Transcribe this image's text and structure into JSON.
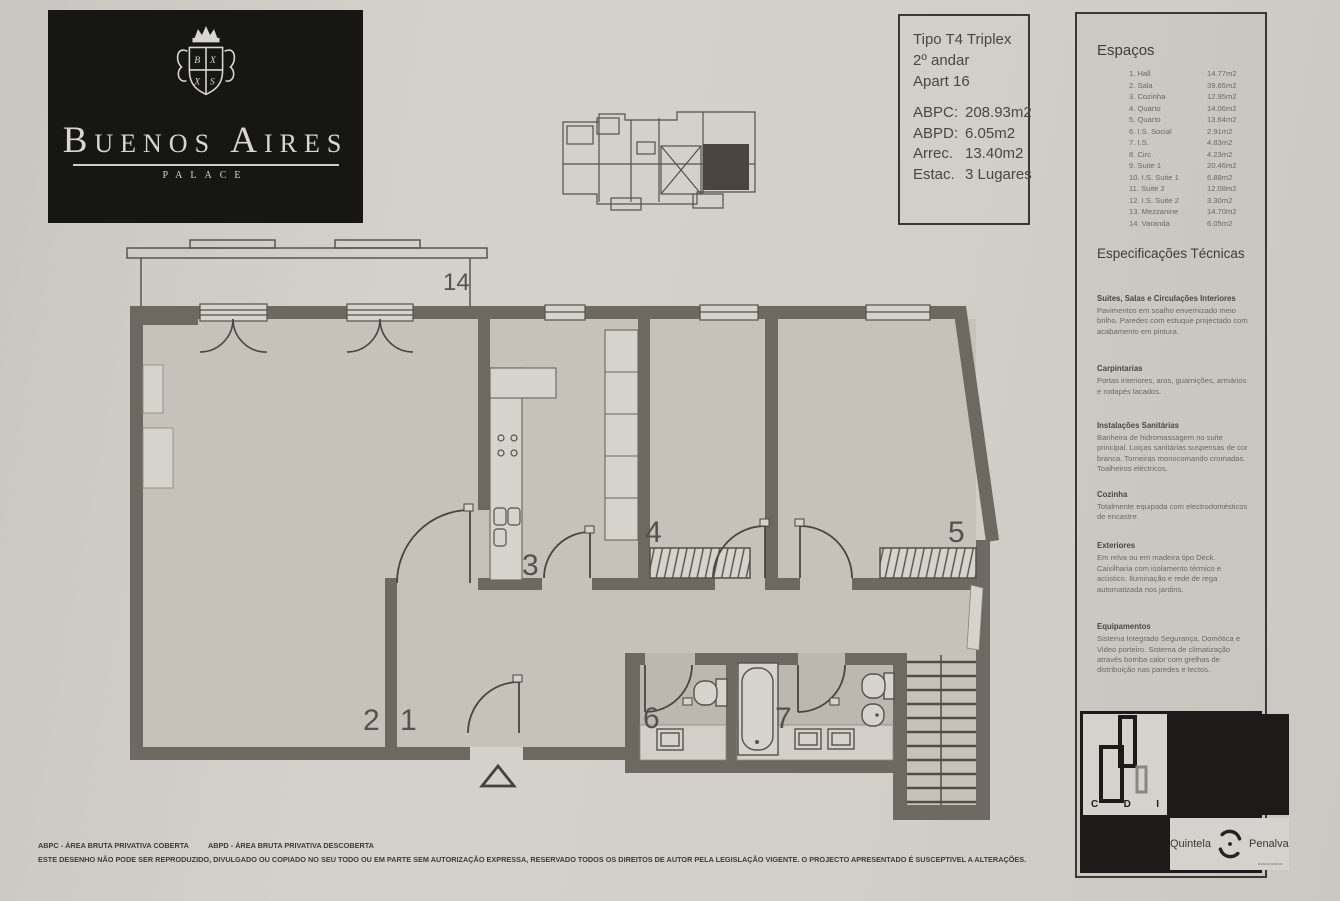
{
  "colors": {
    "paper": "#d1cdc8",
    "wall": "#6e6960",
    "ink": "#46423b",
    "black": "#161614"
  },
  "brand": {
    "name": "Buenos Aires",
    "subtitle": "PALACE"
  },
  "info_box": {
    "line1": "Tipo T4 Triplex",
    "line2": "2º andar",
    "line3": "Apart 16",
    "metrics": [
      {
        "label": "ABPC:",
        "value": "208.93m2"
      },
      {
        "label": "ABPD:",
        "value": "6.05m2"
      },
      {
        "label": "Arrec.",
        "value": "13.40m2"
      },
      {
        "label": "Estac.",
        "value": "3 Lugares"
      }
    ]
  },
  "plan": {
    "labels": {
      "balcony": "14",
      "living": "2",
      "hall": "1",
      "kitchen": "3",
      "bedroom_a": "4",
      "bedroom_b": "5",
      "wc_social": "6",
      "wc_suite": "7"
    }
  },
  "spaces": {
    "title": "Espaços",
    "items": [
      {
        "name": "1. Hall",
        "area": "14.77m2"
      },
      {
        "name": "2. Sala",
        "area": "39.65m2"
      },
      {
        "name": "3. Cozinha",
        "area": "12.95m2"
      },
      {
        "name": "4. Quarto",
        "area": "14.06m2"
      },
      {
        "name": "5. Quarto",
        "area": "13.64m2"
      },
      {
        "name": "6. I.S. Social",
        "area": "2.91m2"
      },
      {
        "name": "7. I.S.",
        "area": "4.83m2"
      },
      {
        "name": "8. Circ.",
        "area": "4.23m2"
      },
      {
        "name": "9. Suite 1",
        "area": "20.46m2"
      },
      {
        "name": "10. I.S. Suite 1",
        "area": "6.88m2"
      },
      {
        "name": "11. Suite 2",
        "area": "12.08m2"
      },
      {
        "name": "12. I.S. Suite 2",
        "area": "3.30m2"
      },
      {
        "name": "13. Mezzanine",
        "area": "14.70m2"
      },
      {
        "name": "14. Varanda",
        "area": "6.05m2"
      }
    ]
  },
  "specs": {
    "title": "Especificações Técnicas",
    "sections": [
      {
        "heading": "Suites, Salas e Circulações Interiores",
        "body": "Pavimentos em soalho envernizado meio brilho. Paredes com estuque projectado com acabamento em pintura."
      },
      {
        "heading": "Carpintarias",
        "body": "Portas interiores, aros, guarnições, armários e rodapés lacados."
      },
      {
        "heading": "Instalações Sanitárias",
        "body": "Banheira de hidromassagem no suite principal. Loiças sanitárias suspensas de cor branca. Torneiras monocomando cromadas. Toalheiros eléctricos."
      },
      {
        "heading": "Cozinha",
        "body": "Totalmente equipada com electrodomésticos de encastre."
      },
      {
        "heading": "Exteriores",
        "body": "Em relva ou em madeira tipo Deck. Caixilharia com isolamento térmico e acústico. Iluminação e rede de rega automatizada nos jardins."
      },
      {
        "heading": "Equipamentos",
        "body": "Sistema Integrado Segurança, Domótica e Video porteiro. Sistema de climatização através bomba calor com grelhas de distribuição nas paredes e tectos."
      }
    ]
  },
  "logos": {
    "cdi": {
      "c": "C",
      "d": "D",
      "i": "I"
    },
    "agency": {
      "left": "Quintela",
      "right": "Penalva",
      "sub": "associados"
    }
  },
  "footer": {
    "abbr1": "ABPC - ÁREA BRUTA PRIVATIVA COBERTA",
    "abbr2": "ABPD - ÁREA BRUTA PRIVATIVA DESCOBERTA",
    "disclaimer": "ESTE DESENHO NÃO PODE SER REPRODUZIDO, DIVULGADO OU COPIADO NO SEU TODO OU EM PARTE SEM AUTORIZAÇÃO EXPRESSA, RESERVADO TODOS OS DIREITOS DE AUTOR PELA LEGISLAÇÃO VIGENTE. O PROJECTO APRESENTADO É SUSCEPTIVEL A ALTERAÇÕES."
  }
}
